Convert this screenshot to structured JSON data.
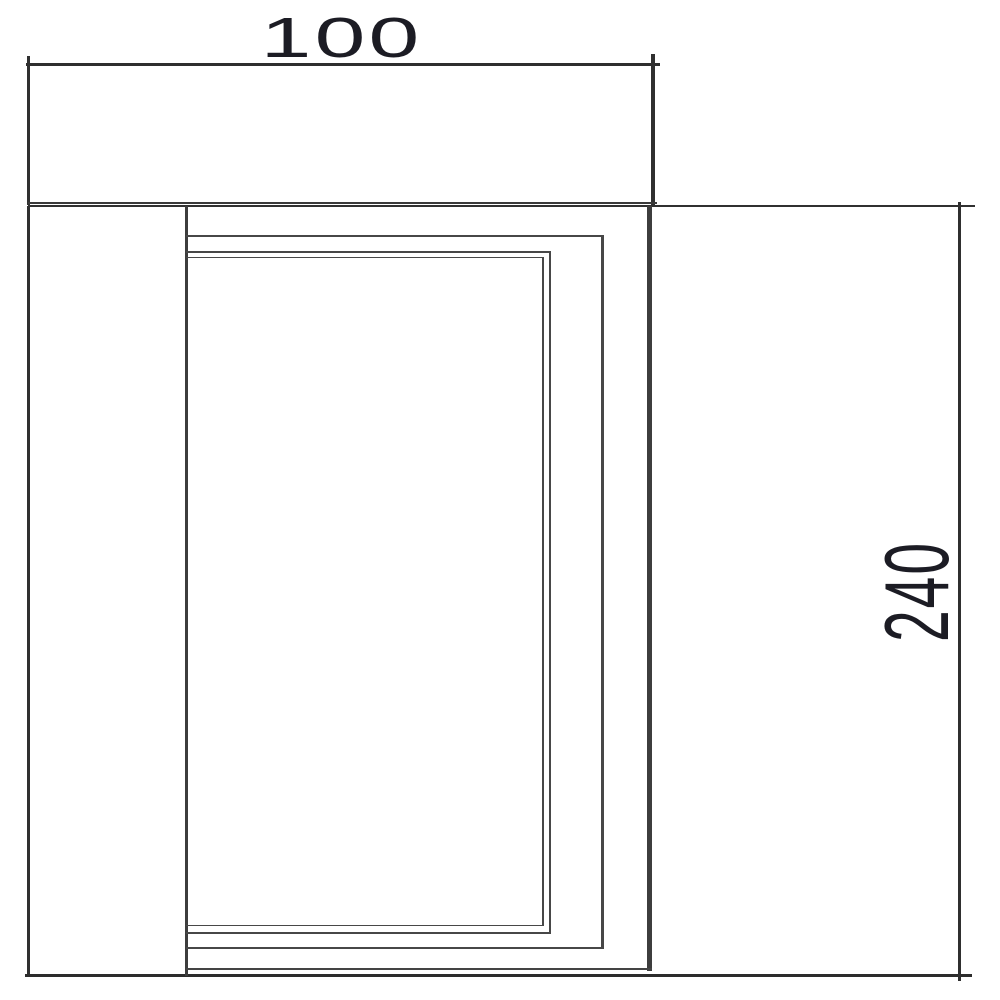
{
  "drawing": {
    "ink_color": "#3a3a3a",
    "dim_text_color": "#1c1c24",
    "background_color": "#ffffff",
    "dimensions": {
      "width": {
        "label": "100"
      },
      "height": {
        "label": "240"
      }
    }
  }
}
